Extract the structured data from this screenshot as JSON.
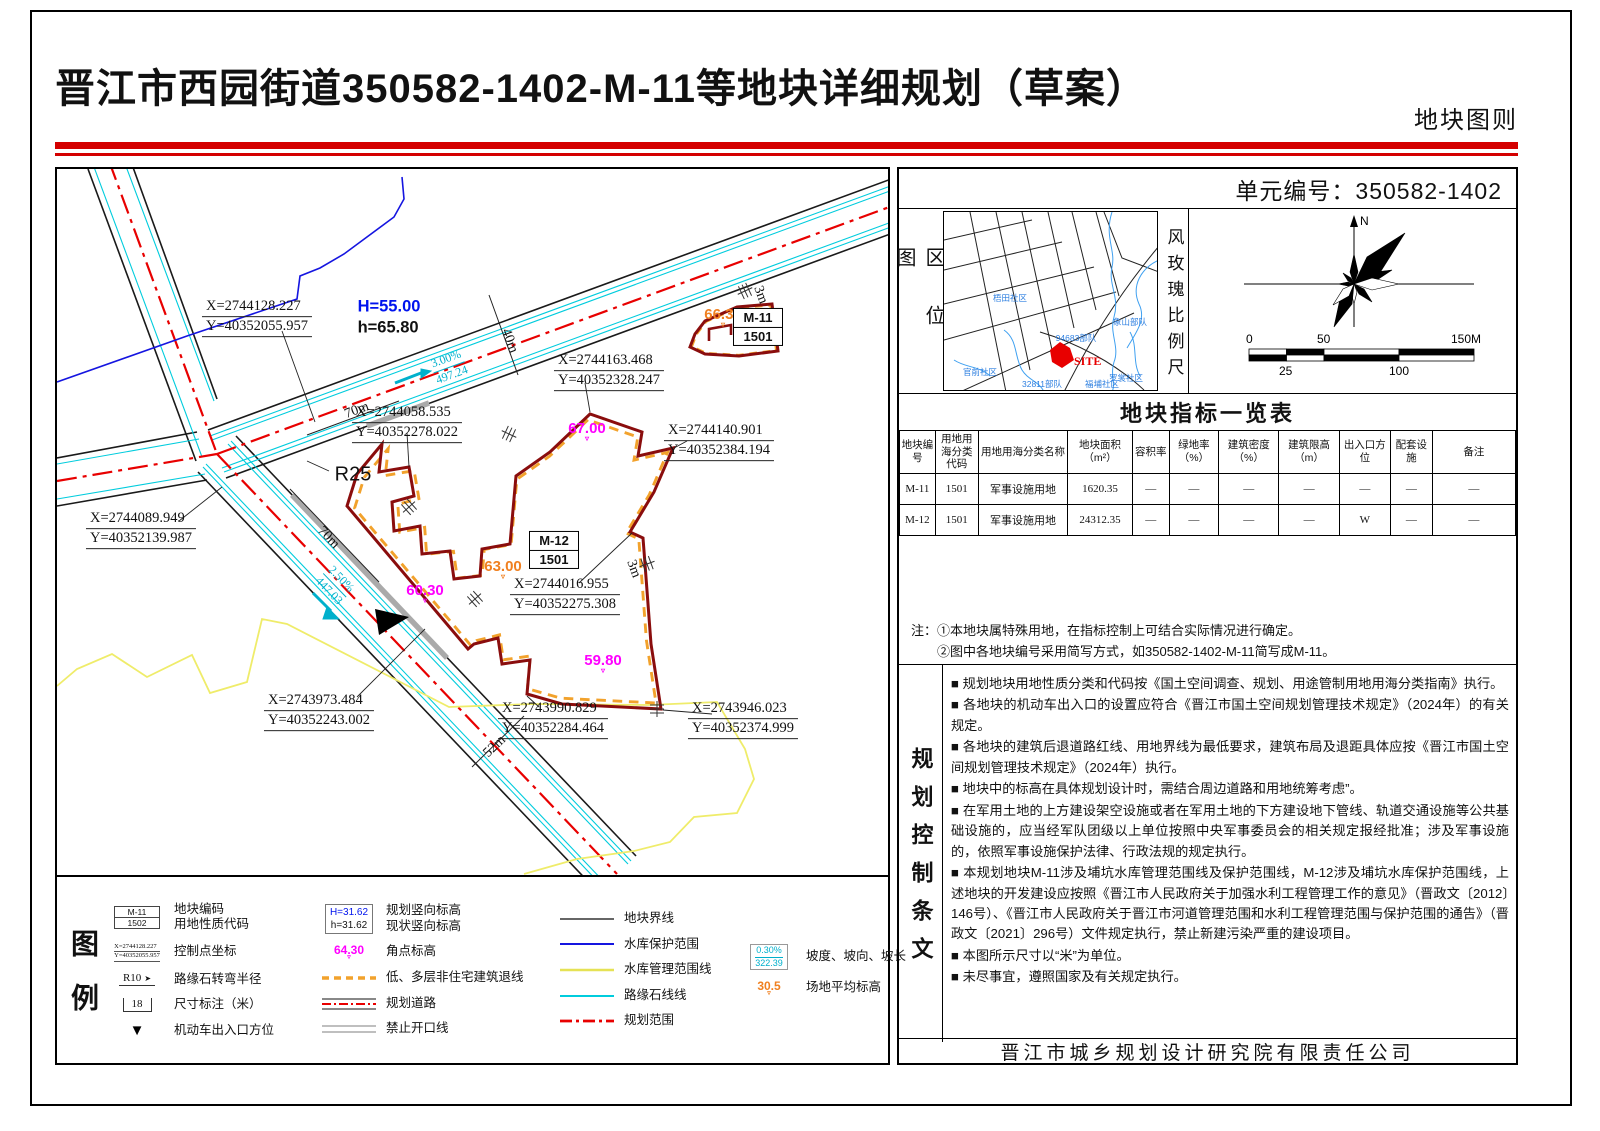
{
  "colors": {
    "accent_red": "#d40000",
    "parcel_boundary": "#8a0d0d",
    "setback_orange": "#f2a22c",
    "corner_magenta": "#ff00ff",
    "avg_orange": "#f08020",
    "curb_cyan": "#00c8dc",
    "protect_blue": "#1515e0",
    "manage_yellow": "#efec6a",
    "site_red": "#e80000"
  },
  "header": {
    "title": "晋江市西园街道350582-1402-M-11等地块详细规划（草案）",
    "sheet_label": "地块图则"
  },
  "unit_no": "单元编号：350582-1402",
  "location_map": {
    "label": "区位图",
    "site": "SITE",
    "places": [
      {
        "t": "梧田社区",
        "x": 66,
        "y": 86
      },
      {
        "t": "94683部队",
        "x": 132,
        "y": 126
      },
      {
        "t": "象山部队",
        "x": 186,
        "y": 110
      },
      {
        "t": "罗裳社区",
        "x": 182,
        "y": 166
      },
      {
        "t": "官前社区",
        "x": 36,
        "y": 160
      },
      {
        "t": "32811部队",
        "x": 98,
        "y": 172
      },
      {
        "t": "福埔社区",
        "x": 158,
        "y": 172
      }
    ]
  },
  "windrose": {
    "label": "风玫瑰比例尺",
    "north": "N",
    "scale_top": [
      "0",
      "50",
      "150M"
    ],
    "scale_bottom": [
      "25",
      "100"
    ]
  },
  "indicator_table": {
    "title": "地块指标一览表",
    "headers": [
      "地块编号",
      "用地用海分类代码",
      "用地用海分类名称",
      "地块面积（m²）",
      "容积率",
      "绿地率（%）",
      "建筑密度（%）",
      "建筑限高（m）",
      "出入口方位",
      "配套设施",
      "备注"
    ],
    "rows": [
      [
        "M-11",
        "1501",
        "军事设施用地",
        "1620.35",
        "—",
        "—",
        "—",
        "—",
        "—",
        "—",
        "—"
      ],
      [
        "M-12",
        "1501",
        "军事设施用地",
        "24312.35",
        "—",
        "—",
        "—",
        "—",
        "W",
        "—",
        "—"
      ]
    ]
  },
  "notes": {
    "head": "注：",
    "lines": [
      "①本地块属特殊用地，在指标控制上可结合实际情况进行确定。",
      "②图中各地块编号采用简写方式，如350582-1402-M-11简写成M-11。"
    ]
  },
  "provisions": {
    "label": "规划控制条文",
    "bullet": "■",
    "items": [
      "规划地块用地性质分类和代码按《国土空间调查、规划、用途管制用地用海分类指南》执行。",
      "各地块的机动车出入口的设置应符合《晋江市国土空间规划管理技术规定》（2024年）的有关规定。",
      "各地块的建筑后退道路红线、用地界线为最低要求，建筑布局及退距具体应按《晋江市国土空 间规划管理技术规定》（2024年）执行。",
      "地块中的标高在具体规划设计时，需结合周边道路和用地统筹考虑”。",
      "在军用土地的上方建设架空设施或者在军用土地的下方建设地下管线、轨道交通设施等公共基础设施的，应当经军队团级以上单位按照中央军事委员会的相关规定报经批准；涉及军事设施的，依照军事设施保护法律、行政法规的规定执行。",
      "本规划地块M-11涉及埔坑水库管理范围线及保护范围线，M-12涉及埔坑水库保护范围线，上述地块的开发建设应按照《晋江市人民政府关于加强水利工程管理工作的意见》（晋政文〔2012〕146号）、《晋江市人民政府关于晋江市河道管理范围和水利工程管理范围与保护范围的通告》（晋政文〔2021〕296号）文件规定执行，禁止新建污染严重的建设项目。",
      "本图所示尺寸以“米”为单位。",
      "未尽事宜，遵照国家及有关规定执行。"
    ]
  },
  "footer": "晋江市城乡规划设计研究院有限责任公司",
  "legend": {
    "label": "图例",
    "col1": [
      {
        "kind": "codebox",
        "t1": "M-11",
        "t2": "1502",
        "label": "地块编码",
        "label2": "用地性质代码"
      },
      {
        "kind": "cp",
        "t1": "X=2744128.227",
        "t2": "Y=40352055.957",
        "label": "控制点坐标"
      },
      {
        "kind": "radius",
        "t1": "R10",
        "label": "路缘石转弯半径"
      },
      {
        "kind": "dim",
        "t1": "18",
        "label": "尺寸标注（米）"
      },
      {
        "kind": "arrow",
        "label": "机动车出入口方位"
      }
    ],
    "col2": [
      {
        "kind": "vert",
        "t1": "H=31.62",
        "t2": "h=31.62",
        "c1": "#0013ee",
        "label": "规划竖向标高",
        "label2": "现状竖向标高"
      },
      {
        "kind": "corner",
        "t1": "64.30",
        "c1": "#ff00ff",
        "label": "角点标高"
      },
      {
        "kind": "line",
        "style": "setback",
        "label": "低、多层非住宅建筑退线"
      },
      {
        "kind": "line",
        "style": "road",
        "label": "规划道路"
      },
      {
        "kind": "line",
        "style": "noopen",
        "label": "禁止开口线"
      }
    ],
    "col3": [
      {
        "kind": "line",
        "style": "parcel",
        "label": "地块界线"
      },
      {
        "kind": "line",
        "style": "protect",
        "label": "水库保护范围"
      },
      {
        "kind": "line",
        "style": "manage",
        "label": "水库管理范围线"
      },
      {
        "kind": "line",
        "style": "curb",
        "label": "路缘石线线"
      },
      {
        "kind": "line",
        "style": "scope",
        "label": "规划范围"
      }
    ],
    "col4": [
      {
        "kind": "slope",
        "t1": "0.30%",
        "t2": "322.39",
        "label": "坡度、坡向、坡长"
      },
      {
        "kind": "corner",
        "t1": "30.5",
        "c1": "#f08020",
        "label": "场地平均标高"
      }
    ]
  },
  "drawing": {
    "annotations": [
      {
        "type": "cp",
        "l1": "X=2744128.227",
        "l2": "Y=40352055.957",
        "x": 200,
        "y": 148
      },
      {
        "type": "pair",
        "l1": "H=55.00",
        "l2": "h=65.80",
        "x": 332,
        "y": 148
      },
      {
        "type": "cp",
        "l1": "X=2744058.535",
        "l2": "Y=40352278.022",
        "x": 350,
        "y": 254
      },
      {
        "type": "cp",
        "l1": "X=2744163.468",
        "l2": "Y=40352328.247",
        "x": 552,
        "y": 202
      },
      {
        "type": "cp",
        "l1": "X=2744140.901",
        "l2": "Y=40352384.194",
        "x": 662,
        "y": 272
      },
      {
        "type": "cp",
        "l1": "X=2744089.949",
        "l2": "Y=40352139.987",
        "x": 84,
        "y": 360
      },
      {
        "type": "cp",
        "l1": "X=2744016.955",
        "l2": "Y=40352275.308",
        "x": 508,
        "y": 426
      },
      {
        "type": "cp",
        "l1": "X=2743973.484",
        "l2": "Y=40352243.002",
        "x": 262,
        "y": 542
      },
      {
        "type": "cp",
        "l1": "X=2743990.829",
        "l2": "Y=40352284.464",
        "x": 496,
        "y": 550
      },
      {
        "type": "cp",
        "l1": "X=2743946.023",
        "l2": "Y=40352374.999",
        "x": 686,
        "y": 550
      },
      {
        "type": "elev",
        "t": "67.00",
        "x": 530,
        "y": 262,
        "c": "#ff00ff"
      },
      {
        "type": "elev",
        "t": "63.00",
        "x": 446,
        "y": 400,
        "c": "#f08020"
      },
      {
        "type": "elev",
        "t": "60.30",
        "x": 368,
        "y": 424,
        "c": "#ff00ff"
      },
      {
        "type": "elev",
        "t": "59.80",
        "x": 546,
        "y": 494,
        "c": "#ff00ff"
      },
      {
        "type": "elev",
        "t": "66.30",
        "x": 666,
        "y": 148,
        "c": "#f08020"
      },
      {
        "type": "slope",
        "l1": "3.00%",
        "l2": "497.24",
        "x": 392,
        "y": 198,
        "r": -20
      },
      {
        "type": "slope",
        "l1": "2.50%",
        "l2": "447.03",
        "x": 278,
        "y": 416,
        "r": 46
      },
      {
        "type": "dim",
        "t": "40m",
        "x": 452,
        "y": 172,
        "r": 70
      },
      {
        "type": "dim",
        "t": "70m",
        "x": 300,
        "y": 242,
        "r": -20
      },
      {
        "type": "dim",
        "t": "70m",
        "x": 271,
        "y": 369,
        "r": 46
      },
      {
        "type": "dim",
        "t": "52m",
        "x": 438,
        "y": 578,
        "r": -44
      },
      {
        "type": "dim",
        "t": "3m",
        "x": 576,
        "y": 400,
        "r": 70
      },
      {
        "type": "dim",
        "t": "3m",
        "x": 703,
        "y": 126,
        "r": 70
      },
      {
        "type": "label",
        "t": "R25",
        "x": 296,
        "y": 306
      },
      {
        "type": "pbox",
        "l1": "M-11",
        "l2": "1501",
        "x": 701,
        "y": 158
      },
      {
        "type": "pbox",
        "l1": "M-12",
        "l2": "1501",
        "x": 497,
        "y": 381
      }
    ]
  }
}
